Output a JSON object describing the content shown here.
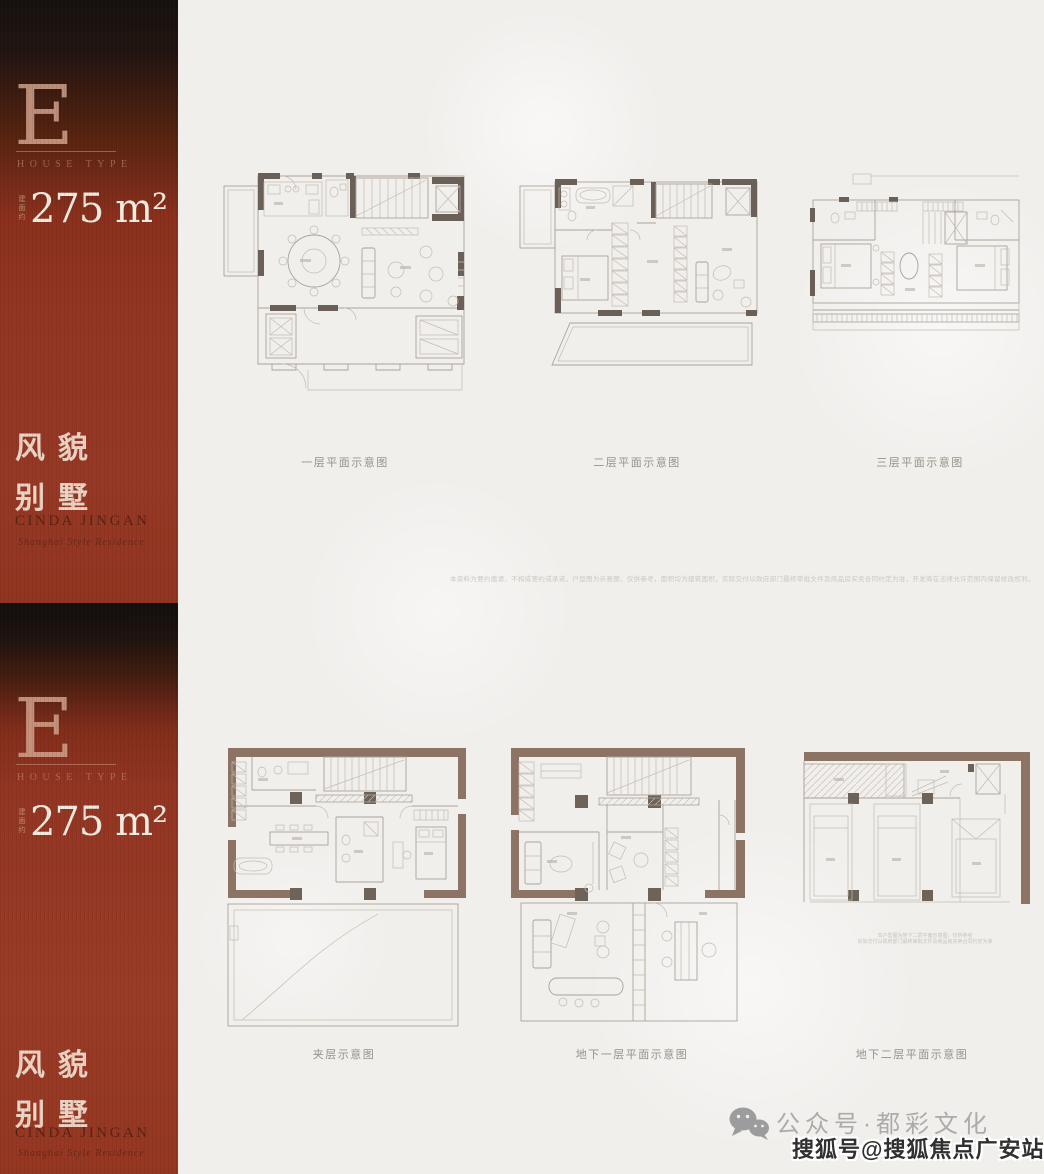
{
  "colors": {
    "sidebar_red": "#943522",
    "sidebar_dark": "#15100d",
    "sidebar_accent_text": "#ecd3c3",
    "area_text": "#f2ebe0",
    "brand_text": "#531f13",
    "plan_wall_dark": "#6a6057",
    "plan_wall_brown": "#8d7363",
    "plan_line": "#aaa29a",
    "plan_label_text": "#97918a",
    "footer_gray": "#ababab",
    "watermark_text": "#303030",
    "background": "#f1efec"
  },
  "panels": [
    {
      "type_letter": "E",
      "type_label": "HOUSE TYPE",
      "area_prefix": "建面约",
      "area_value": "275 m²",
      "tagline_line1": "风貌",
      "tagline_line2": "别墅",
      "brand": "CINDA JINGAN",
      "brand_script": "Shanghai Style Residence",
      "plans": [
        {
          "label": "一层平面示意图"
        },
        {
          "label": "二层平面示意图"
        },
        {
          "label": "三层平面示意图"
        }
      ],
      "disclaimer": "本资料为要约邀请，不构成要约或承诺，户型图为示意图，仅供参考，面积均为建筑面积，实际交付以政府部门最终审批文件及商品房买卖合同约定为准，开发商在法律允许范围内保留修改权利，敬请留意最新资料"
    },
    {
      "type_letter": "E",
      "type_label": "HOUSE TYPE",
      "area_prefix": "建面约",
      "area_value": "275 m²",
      "tagline_line1": "风貌",
      "tagline_line2": "别墅",
      "brand": "CINDA JINGAN",
      "brand_script": "Shanghai Style Residence",
      "plans": [
        {
          "label": "夹层示意图"
        },
        {
          "label": "地下一层平面示意图"
        },
        {
          "label": "地下二层平面示意图"
        }
      ],
      "note_line1": "本户型图为地下二层平面示意图，仅供参考",
      "note_line2": "实际交付以政府部门最终审批文件及商品房买卖合同约定为准"
    }
  ],
  "footer": {
    "wechat_label": "公众号·都彩文化",
    "watermark": "搜狐号@搜狐焦点广安站"
  }
}
